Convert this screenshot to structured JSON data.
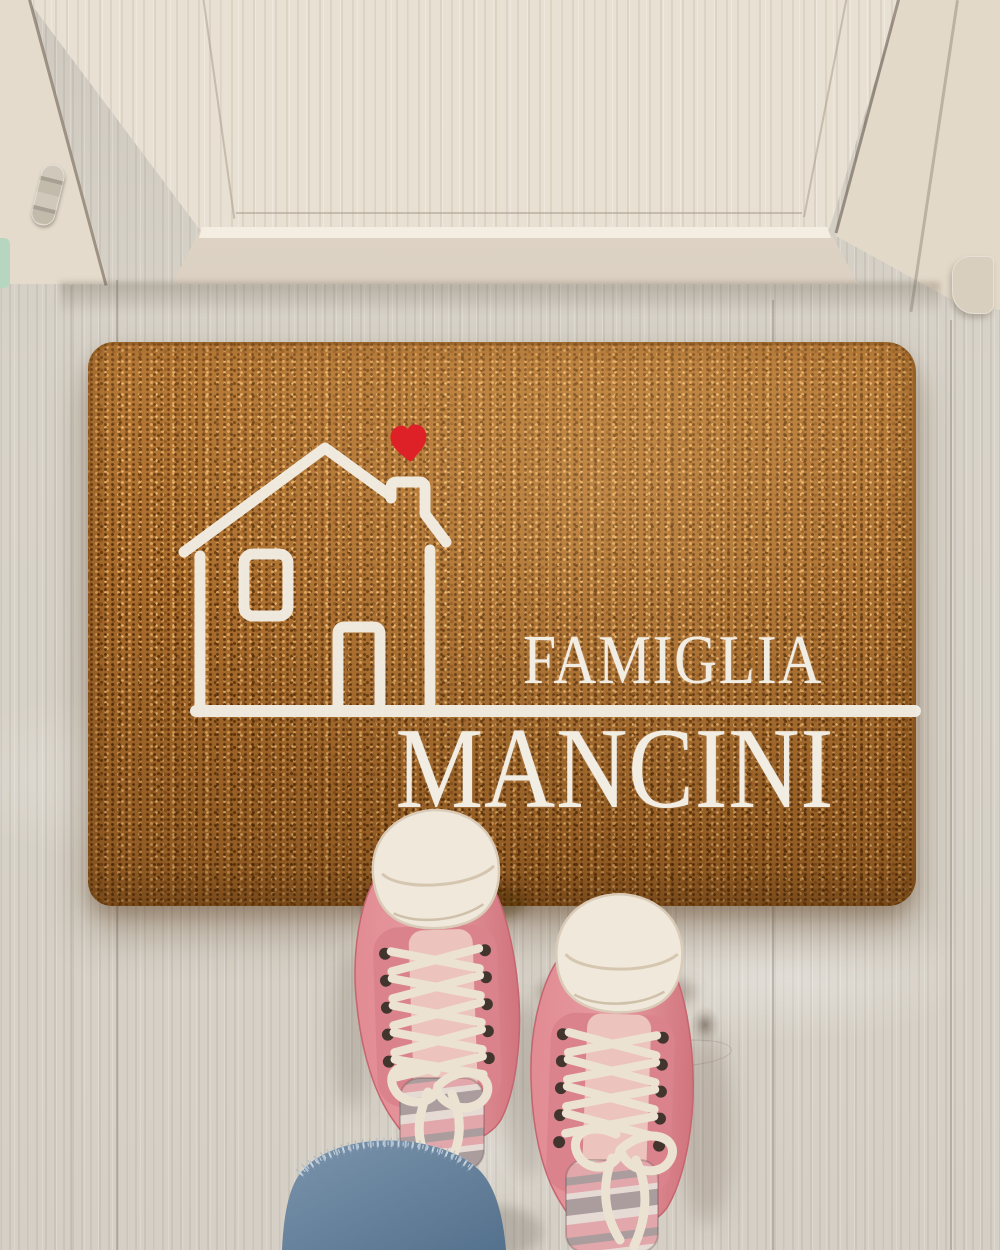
{
  "doormat": {
    "line1": "FAMIGLIA",
    "line2": "MANCINI",
    "motif": "house-outline-with-heart",
    "colors": {
      "coir_base": "#a96c2c",
      "print": "#f2ede3",
      "heart": "#de2127"
    }
  },
  "environment": {
    "door_wood_color": "#e8e0d3",
    "floor_wood_color": "#d7d2c8"
  },
  "person": {
    "shoe_color": "#e08890",
    "toe_cap_color": "#f0e8db",
    "lace_color": "#ece2d2",
    "sock_stripe_colors": [
      "#ab9c9d",
      "#e6dbd4",
      "#e2a7ab"
    ],
    "jeans_color": "#6a86a0"
  }
}
